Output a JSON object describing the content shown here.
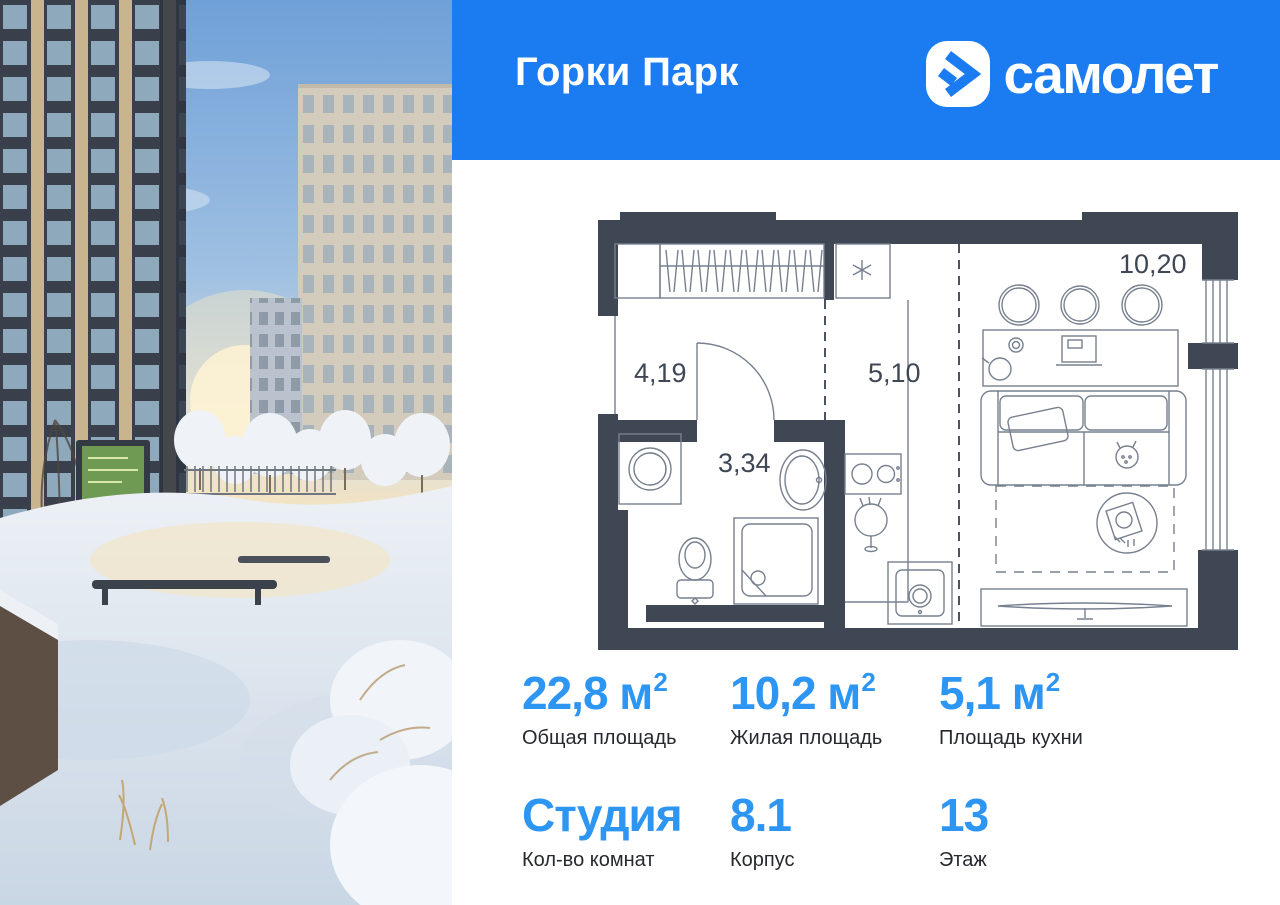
{
  "header": {
    "project_title": "Горки Парк",
    "brand_wordmark": "самолет"
  },
  "floor_plan": {
    "room_labels": {
      "hallway": "4,19",
      "bathroom": "3,34",
      "kitchen": "5,10",
      "living_room": "10,20"
    }
  },
  "stats": {
    "row1": [
      {
        "value": "22,8 м",
        "sup": "2",
        "label": "Общая площадь"
      },
      {
        "value": "10,2 м",
        "sup": "2",
        "label": "Жилая площадь"
      },
      {
        "value": "5,1 м",
        "sup": "2",
        "label": "Площадь кухни"
      }
    ],
    "row2": [
      {
        "value": "Студия",
        "sup": "",
        "label": "Кол-во комнат"
      },
      {
        "value": "8.1",
        "sup": "",
        "label": "Корпус"
      },
      {
        "value": "13",
        "sup": "",
        "label": "Этаж"
      }
    ]
  },
  "colors": {
    "header_blue": "#1B7CF2",
    "accent_blue": "#2D96F3",
    "plan_wall": "#3F4755",
    "plan_line": "#77808F",
    "label_text": "#26292E"
  }
}
